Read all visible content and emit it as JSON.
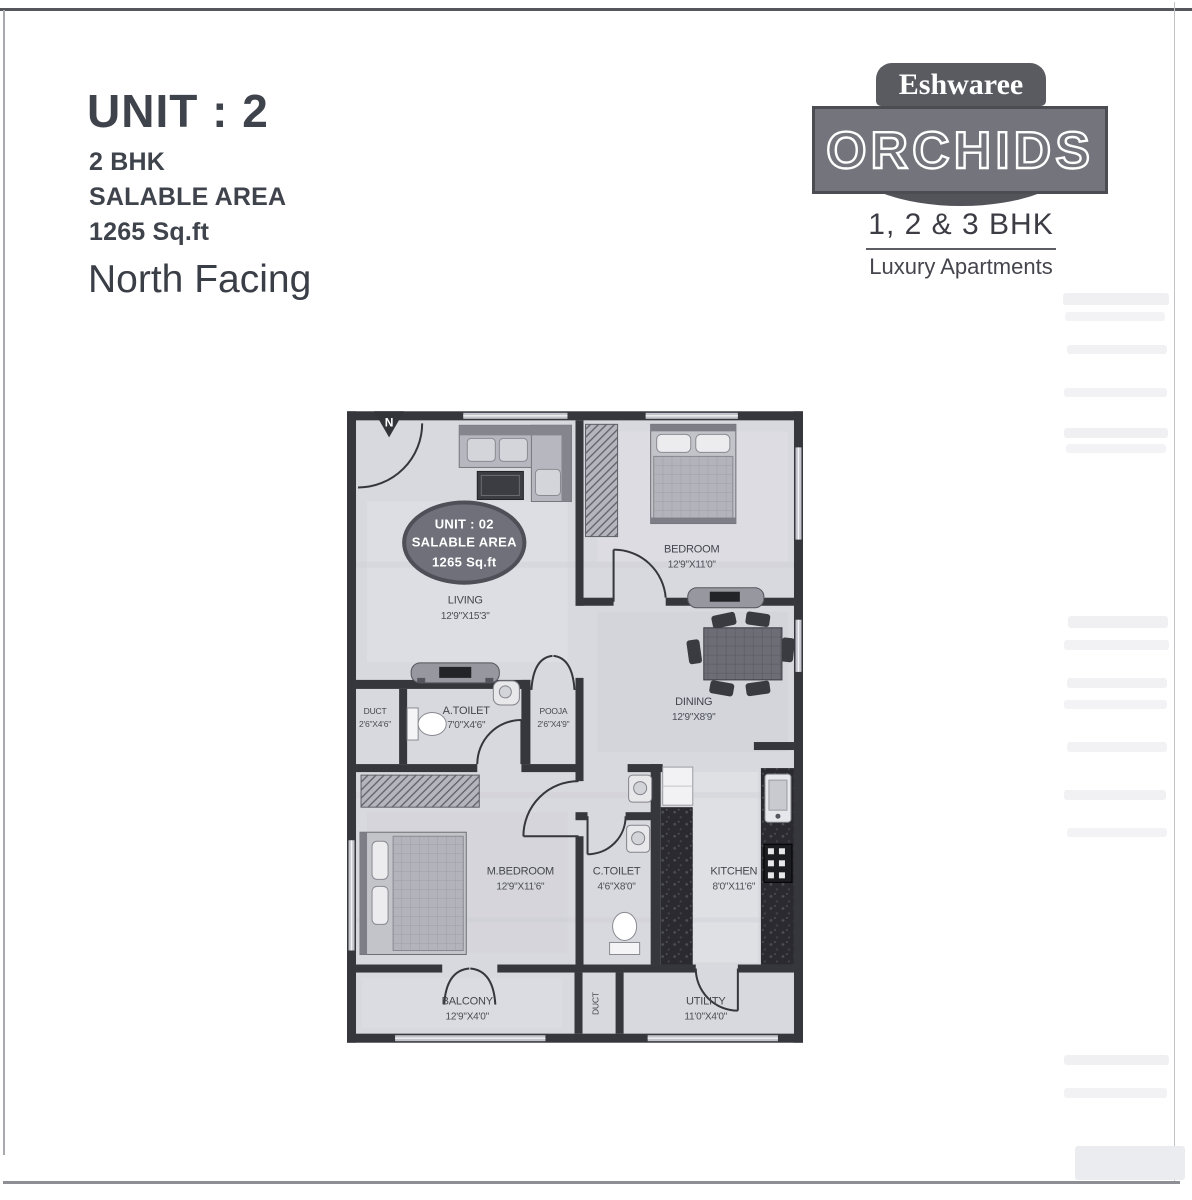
{
  "header": {
    "unit_title": "UNIT : 2",
    "bhk": "2 BHK",
    "salable_label": "SALABLE AREA",
    "salable_value": "1265 Sq.ft",
    "facing": "North Facing"
  },
  "logo": {
    "brand": "Eshwaree",
    "name": "ORCHIDS",
    "bhk_line": "1, 2 & 3 BHK",
    "tagline": "Luxury Apartments"
  },
  "plan": {
    "north": "N",
    "badge": {
      "line1": "UNIT : 02",
      "line2": "SALABLE AREA",
      "line3": "1265 Sq.ft"
    },
    "rooms": {
      "living": {
        "name": "LIVING",
        "dims": "12'9\"X15'3\""
      },
      "bedroom": {
        "name": "BEDROOM",
        "dims": "12'9\"X11'0\""
      },
      "dining": {
        "name": "DINING",
        "dims": "12'9\"X8'9\""
      },
      "duct": {
        "name": "DUCT",
        "dims": "2'6\"X4'6\""
      },
      "atoilet": {
        "name": "A.TOILET",
        "dims": "7'0\"X4'6\""
      },
      "pooja": {
        "name": "POOJA",
        "dims": "2'6\"X4'9\""
      },
      "mbedroom": {
        "name": "M.BEDROOM",
        "dims": "12'9\"X11'6\""
      },
      "ctoilet": {
        "name": "C.TOILET",
        "dims": "4'6\"X8'0\""
      },
      "kitchen": {
        "name": "KITCHEN",
        "dims": "8'0\"X11'6\""
      },
      "balcony": {
        "name": "BALCONY",
        "dims": "12'9\"X4'0\""
      },
      "duct2": {
        "name": "DUCT"
      },
      "utility": {
        "name": "UTILITY",
        "dims": "11'0\"X4'0\""
      }
    },
    "colors": {
      "wall": "#36363d",
      "floor": "#d8d9de",
      "counter": "#2a2a30",
      "badge": "#70707a"
    }
  }
}
